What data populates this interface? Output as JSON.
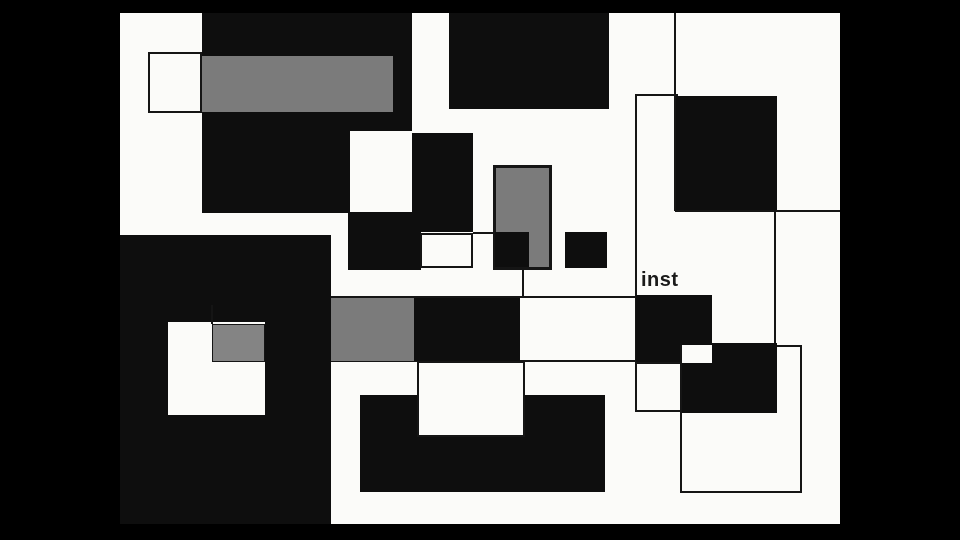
{
  "frame": {
    "kind": "abstract-geometric-video-frame",
    "label": {
      "text": "inst"
    }
  },
  "palette": {
    "letterbox": "#000000",
    "canvas": "#fbfbf9",
    "black": "#0e0e0e",
    "gray": "#7b7b7b",
    "gray_light": "#848484",
    "white": "#fbfbf9",
    "line": "#151515",
    "text": "#1a1a1a"
  },
  "composition": {
    "shapes": [
      {
        "name": "canvas-background",
        "x": 120,
        "y": 13,
        "w": 720,
        "h": 511,
        "fill": "canvas"
      },
      {
        "name": "topleft-black-rect",
        "x": 202,
        "y": 13,
        "w": 210,
        "h": 200,
        "fill": "black"
      },
      {
        "name": "topleft-gray-bar",
        "x": 158,
        "y": 56,
        "w": 235,
        "h": 56,
        "fill": "gray"
      },
      {
        "name": "outlined-white-square-topleft",
        "x": 148,
        "y": 52,
        "w": 54,
        "h": 61,
        "fill": "white",
        "stroke": 2
      },
      {
        "name": "top-center-black-rect",
        "x": 449,
        "y": 13,
        "w": 160,
        "h": 96,
        "fill": "black"
      },
      {
        "name": "white-square-mid-upper",
        "x": 350,
        "y": 131,
        "w": 63,
        "h": 81,
        "fill": "white"
      },
      {
        "name": "central-black-rect-a",
        "x": 412,
        "y": 133,
        "w": 61,
        "h": 99,
        "fill": "black"
      },
      {
        "name": "central-black-rect-b",
        "x": 348,
        "y": 212,
        "w": 73,
        "h": 58,
        "fill": "black"
      },
      {
        "name": "outlined-white-rect-center",
        "x": 420,
        "y": 233,
        "w": 53,
        "h": 35,
        "fill": "white",
        "stroke": 2
      },
      {
        "name": "line-h-center-stub",
        "x": 473,
        "y": 232,
        "w": 22,
        "h": 2,
        "fill": "line"
      },
      {
        "name": "outlined-gray-rect-center",
        "x": 493,
        "y": 165,
        "w": 59,
        "h": 105,
        "fill": "gray",
        "stroke": 3
      },
      {
        "name": "small-black-square-left",
        "x": 495,
        "y": 232,
        "w": 34,
        "h": 35,
        "fill": "black"
      },
      {
        "name": "line-v-below-square",
        "x": 522,
        "y": 267,
        "w": 2,
        "h": 31,
        "fill": "line"
      },
      {
        "name": "small-black-square-right",
        "x": 565,
        "y": 232,
        "w": 42,
        "h": 36,
        "fill": "black"
      },
      {
        "name": "line-v-long-center",
        "x": 635,
        "y": 95,
        "w": 2,
        "h": 317,
        "fill": "line"
      },
      {
        "name": "line-h-top-stub",
        "x": 635,
        "y": 94,
        "w": 43,
        "h": 2,
        "fill": "line"
      },
      {
        "name": "line-v-topright",
        "x": 674,
        "y": 13,
        "w": 2,
        "h": 198,
        "fill": "line"
      },
      {
        "name": "topright-black-rect",
        "x": 676,
        "y": 96,
        "w": 101,
        "h": 115,
        "fill": "black"
      },
      {
        "name": "line-h-topright",
        "x": 675,
        "y": 210,
        "w": 165,
        "h": 2,
        "fill": "line"
      },
      {
        "name": "line-v-right",
        "x": 774,
        "y": 210,
        "w": 2,
        "h": 135,
        "fill": "line"
      },
      {
        "name": "line-h-middle",
        "x": 331,
        "y": 296,
        "w": 307,
        "h": 2,
        "fill": "line"
      },
      {
        "name": "line-h-lower",
        "x": 331,
        "y": 360,
        "w": 305,
        "h": 2,
        "fill": "line"
      },
      {
        "name": "bottomleft-black-block",
        "x": 120,
        "y": 235,
        "w": 211,
        "h": 289,
        "fill": "black"
      },
      {
        "name": "white-square-bottomleft",
        "x": 168,
        "y": 322,
        "w": 97,
        "h": 93,
        "fill": "white"
      },
      {
        "name": "line-v-stub-bottomleft",
        "x": 211,
        "y": 305,
        "w": 2,
        "h": 19,
        "fill": "line"
      },
      {
        "name": "gray-square-bottomleft",
        "x": 212,
        "y": 324,
        "w": 53,
        "h": 38,
        "fill": "gray_light",
        "stroke": 1
      },
      {
        "name": "gray-rect-midband",
        "x": 331,
        "y": 298,
        "w": 83,
        "h": 63,
        "fill": "gray"
      },
      {
        "name": "black-rect-midband",
        "x": 414,
        "y": 298,
        "w": 106,
        "h": 63,
        "fill": "black"
      },
      {
        "name": "black-rect-inst",
        "x": 636,
        "y": 295,
        "w": 76,
        "h": 68,
        "fill": "black"
      },
      {
        "name": "outlined-white-square-bottom",
        "x": 635,
        "y": 362,
        "w": 47,
        "h": 50,
        "fill": "white",
        "stroke": 2
      },
      {
        "name": "outline-rect-bottomright",
        "x": 680,
        "y": 345,
        "w": 122,
        "h": 148,
        "stroke": 2
      },
      {
        "name": "black-rect-bottomright",
        "x": 682,
        "y": 343,
        "w": 95,
        "h": 70,
        "fill": "black"
      },
      {
        "name": "white-square-notch-right",
        "x": 682,
        "y": 345,
        "w": 30,
        "h": 18,
        "fill": "white"
      },
      {
        "name": "bottom-black-rect",
        "x": 360,
        "y": 395,
        "w": 245,
        "h": 97,
        "fill": "black"
      },
      {
        "name": "outlined-white-rect-bottom",
        "x": 417,
        "y": 361,
        "w": 108,
        "h": 76,
        "fill": "white",
        "stroke": 2
      }
    ]
  }
}
